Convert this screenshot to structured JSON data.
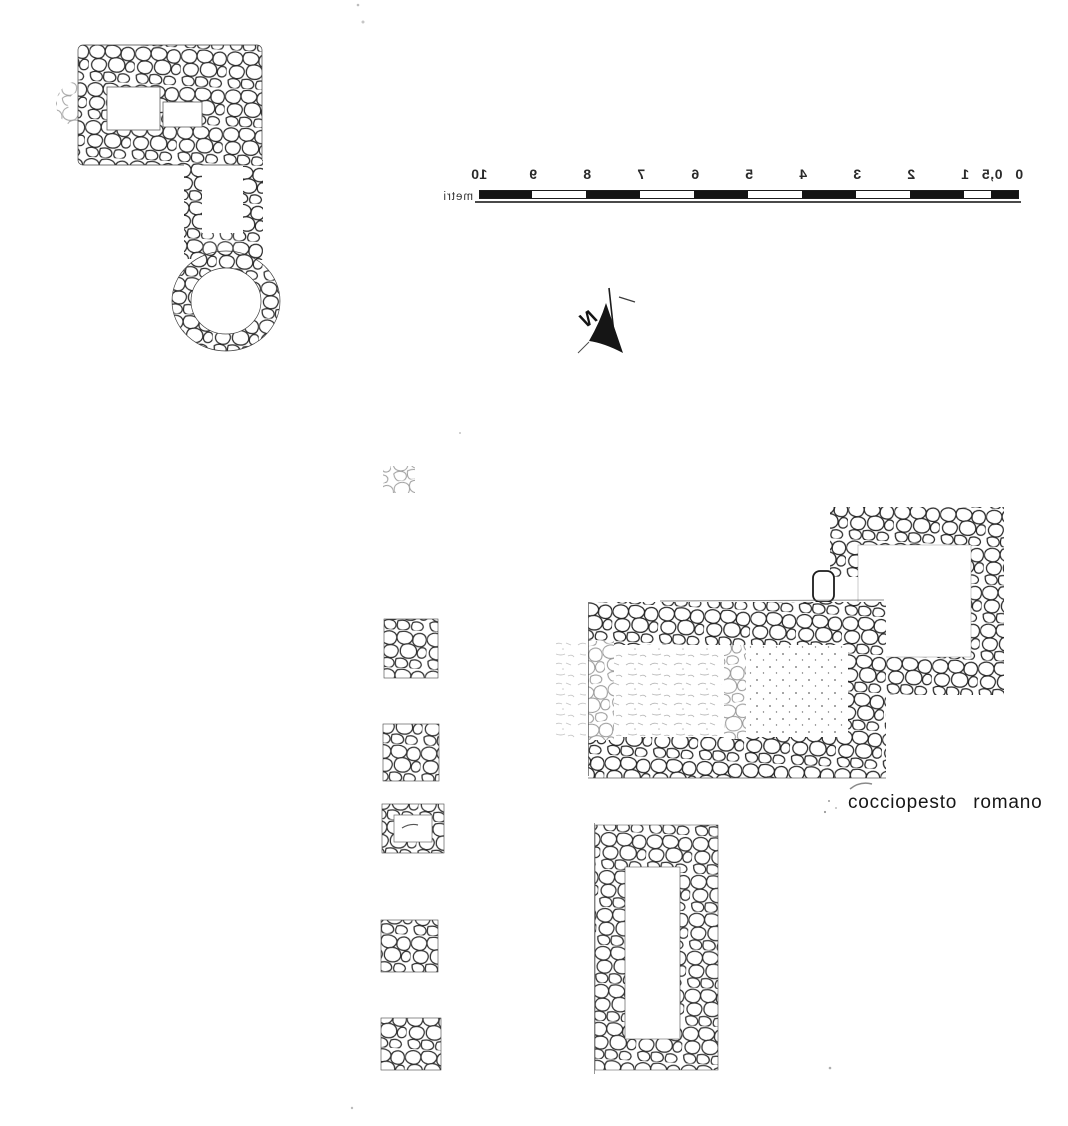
{
  "page": {
    "background": "#ffffff",
    "ink_color": "#1c1c1c",
    "faint_ink_color": "#8f8f8f"
  },
  "scale_bar": {
    "unit_label": "metri",
    "tick_labels": [
      "0",
      "0,5",
      "1",
      "2",
      "3",
      "4",
      "5",
      "6",
      "7",
      "8",
      "9",
      "10"
    ],
    "mirrored": true
  },
  "north_arrow": {
    "label": "N",
    "mirrored": true
  },
  "annotations": {
    "floor_label": "cocciopesto romano"
  },
  "structures": {
    "kiln_building": "kiln-building-plan",
    "pila_column": "pillar-bases-column",
    "roman_building": "roman-building-plan",
    "square_room": "square-room-plan",
    "rectangular_enclosure": "rectangular-enclosure-plan"
  }
}
